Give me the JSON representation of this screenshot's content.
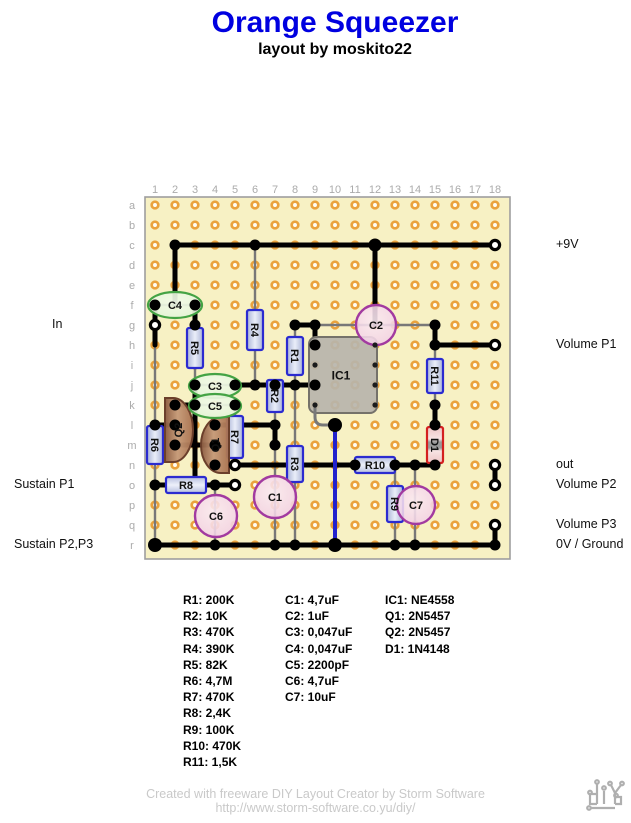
{
  "title": "Orange Squeezer",
  "subtitle": "layout by moskito22",
  "colors": {
    "title": "#0000E0",
    "board_bg": "#F7F1C4",
    "board_border": "#9E9E9E",
    "hole_ring": "#EAA23C",
    "hole_center": "#FFFDF4",
    "wire": "#000000",
    "blue_wire": "#2222CC",
    "lead": "#787878",
    "resistor_border": "#2B2BD0",
    "diode_border": "#D42020",
    "cap_border": "#A23AA0",
    "ecap_border": "#44A344",
    "transistor_border": "#6B3F2B",
    "ic_border": "#75726A",
    "grid_label": "#ABABAB",
    "footer": "#C9C9C9",
    "label_text": "#111111"
  },
  "board": {
    "origin_x": 155,
    "origin_y": 205,
    "pitch": 20,
    "cols": 18,
    "rows": 18,
    "frame": {
      "x": 145,
      "y": 197,
      "w": 365,
      "h": 362
    },
    "col_labels": [
      "1",
      "2",
      "3",
      "4",
      "5",
      "6",
      "7",
      "8",
      "9",
      "10",
      "11",
      "12",
      "13",
      "14",
      "15",
      "16",
      "17",
      "18"
    ],
    "row_labels": [
      "a",
      "b",
      "c",
      "d",
      "e",
      "f",
      "g",
      "h",
      "i",
      "j",
      "k",
      "l",
      "m",
      "n",
      "o",
      "p",
      "q",
      "r"
    ]
  },
  "left_labels": [
    {
      "text": "In",
      "x": 52,
      "row": 7
    },
    {
      "text": "Sustain P1",
      "x": 14,
      "row": 15
    },
    {
      "text": "Sustain P2,P3",
      "x": 14,
      "row": 18
    }
  ],
  "right_labels": [
    {
      "text": "+9V",
      "x": 556,
      "row": 3
    },
    {
      "text": "Volume P1",
      "x": 556,
      "row": 8
    },
    {
      "text": "out",
      "x": 556,
      "row": 14
    },
    {
      "text": "Volume P2",
      "x": 556,
      "row": 15
    },
    {
      "text": "Volume P3",
      "x": 556,
      "row": 17
    },
    {
      "text": "0V / Ground",
      "x": 556,
      "row": 18
    }
  ],
  "wires": [
    {
      "a": [
        2,
        3
      ],
      "b": [
        18,
        3
      ]
    },
    {
      "a": [
        2,
        3
      ],
      "b": [
        2,
        6
      ]
    },
    {
      "a": [
        12,
        3
      ],
      "b": [
        12,
        7
      ]
    },
    {
      "a": [
        8,
        7
      ],
      "b": [
        9,
        7
      ]
    },
    {
      "a": [
        9,
        7
      ],
      "b": [
        9,
        8
      ]
    },
    {
      "a": [
        15,
        7
      ],
      "b": [
        15,
        8
      ]
    },
    {
      "a": [
        15,
        8
      ],
      "b": [
        18,
        8
      ]
    },
    {
      "a": [
        5,
        10
      ],
      "b": [
        9,
        10
      ]
    },
    {
      "a": [
        1,
        6
      ],
      "b": [
        1,
        8
      ]
    },
    {
      "a": [
        3,
        6
      ],
      "b": [
        3,
        7
      ]
    },
    {
      "a": [
        3,
        10
      ],
      "b": [
        3,
        15
      ]
    },
    {
      "a": [
        2,
        11
      ],
      "b": [
        3,
        11
      ]
    },
    {
      "a": [
        1,
        12
      ],
      "b": [
        2,
        12
      ]
    },
    {
      "a": [
        2,
        13
      ],
      "b": [
        4,
        13
      ]
    },
    {
      "a": [
        4,
        12
      ],
      "b": [
        7,
        12
      ]
    },
    {
      "a": [
        7,
        12
      ],
      "b": [
        7,
        13
      ]
    },
    {
      "a": [
        5,
        14
      ],
      "b": [
        11,
        14
      ]
    },
    {
      "a": [
        13,
        14
      ],
      "b": [
        15,
        14
      ]
    },
    {
      "a": [
        15,
        11
      ],
      "b": [
        15,
        12
      ]
    },
    {
      "a": [
        1,
        15
      ],
      "b": [
        5,
        15
      ]
    },
    {
      "a": [
        1,
        18
      ],
      "b": [
        18,
        18
      ]
    },
    {
      "a": [
        18,
        14
      ],
      "b": [
        18,
        15
      ]
    },
    {
      "a": [
        18,
        17
      ],
      "b": [
        18,
        18
      ]
    },
    {
      "a": [
        10,
        12
      ],
      "b": [
        10,
        18
      ],
      "color": "blue"
    }
  ],
  "leads": [
    {
      "a": [
        6,
        3
      ],
      "b": [
        6,
        10
      ]
    },
    {
      "a": [
        3,
        7
      ],
      "b": [
        3,
        10
      ]
    },
    {
      "a": [
        8,
        7
      ],
      "b": [
        8,
        10
      ]
    },
    {
      "a": [
        7,
        10
      ],
      "b": [
        7,
        12
      ]
    },
    {
      "a": [
        8,
        10
      ],
      "b": [
        8,
        18
      ]
    },
    {
      "a": [
        1,
        8
      ],
      "b": [
        1,
        18
      ]
    },
    {
      "a": [
        5,
        11
      ],
      "b": [
        5,
        14
      ]
    },
    {
      "a": [
        13,
        14
      ],
      "b": [
        13,
        18
      ]
    },
    {
      "a": [
        15,
        8
      ],
      "b": [
        15,
        11
      ]
    },
    {
      "a": [
        15,
        12
      ],
      "b": [
        15,
        14
      ]
    },
    {
      "a": [
        7,
        13
      ],
      "b": [
        7,
        18
      ]
    },
    {
      "a": [
        9,
        7
      ],
      "b": [
        15,
        7
      ]
    },
    {
      "a": [
        4,
        15
      ],
      "b": [
        4,
        18
      ]
    },
    {
      "a": [
        14,
        14
      ],
      "b": [
        14,
        18
      ]
    },
    {
      "a": [
        1,
        6
      ],
      "b": [
        3,
        6
      ]
    },
    {
      "a": [
        3,
        10
      ],
      "b": [
        5,
        10
      ]
    },
    {
      "a": [
        3,
        11
      ],
      "b": [
        5,
        11
      ]
    }
  ],
  "ic_bent_lead": {
    "from": [
      9,
      11
    ],
    "to": [
      10,
      12
    ]
  },
  "dots": {
    "solid": [
      [
        2,
        3
      ],
      [
        6,
        3
      ],
      [
        12,
        3,
        6.5
      ],
      [
        1,
        6
      ],
      [
        3,
        6
      ],
      [
        3,
        7
      ],
      [
        8,
        7
      ],
      [
        9,
        7
      ],
      [
        15,
        7
      ],
      [
        9,
        8
      ],
      [
        15,
        8
      ],
      [
        3,
        10
      ],
      [
        5,
        10
      ],
      [
        6,
        10
      ],
      [
        7,
        10
      ],
      [
        8,
        10
      ],
      [
        9,
        10
      ],
      [
        2,
        11
      ],
      [
        3,
        11
      ],
      [
        5,
        11
      ],
      [
        15,
        11
      ],
      [
        1,
        12
      ],
      [
        2,
        12
      ],
      [
        4,
        12
      ],
      [
        7,
        12
      ],
      [
        15,
        12
      ],
      [
        10,
        12,
        7
      ],
      [
        2,
        13
      ],
      [
        4,
        13
      ],
      [
        7,
        13
      ],
      [
        4,
        14
      ],
      [
        11,
        14
      ],
      [
        13,
        14
      ],
      [
        14,
        14
      ],
      [
        15,
        14
      ],
      [
        1,
        15
      ],
      [
        4,
        15
      ],
      [
        1,
        18,
        7
      ],
      [
        4,
        18
      ],
      [
        7,
        18
      ],
      [
        8,
        18
      ],
      [
        10,
        18,
        7
      ],
      [
        13,
        18
      ],
      [
        14,
        18
      ],
      [
        18,
        18
      ]
    ],
    "hollow": [
      [
        1,
        7
      ],
      [
        18,
        3
      ],
      [
        18,
        8
      ],
      [
        18,
        14
      ],
      [
        18,
        15
      ],
      [
        18,
        17
      ],
      [
        5,
        14
      ],
      [
        5,
        15
      ]
    ],
    "pins": [
      [
        9,
        9
      ],
      [
        9,
        11
      ],
      [
        12,
        8
      ],
      [
        12,
        9
      ],
      [
        12,
        10
      ],
      [
        12,
        11
      ]
    ]
  },
  "components": [
    {
      "id": "R4",
      "type": "vres",
      "label": "R4",
      "cx": 255,
      "y1": 310,
      "y2": 350
    },
    {
      "id": "R5",
      "type": "vres",
      "label": "R5",
      "cx": 195,
      "y1": 328,
      "y2": 368
    },
    {
      "id": "R1",
      "type": "vres",
      "label": "R1",
      "cx": 295,
      "y1": 337,
      "y2": 375
    },
    {
      "id": "R2",
      "type": "vres",
      "label": "R2",
      "cx": 275,
      "y1": 380,
      "y2": 412
    },
    {
      "id": "R3",
      "type": "vres",
      "label": "R3",
      "cx": 295,
      "y1": 446,
      "y2": 482
    },
    {
      "id": "R6",
      "type": "vres",
      "label": "R6",
      "cx": 155,
      "y1": 426,
      "y2": 464
    },
    {
      "id": "R7",
      "type": "vres",
      "label": "R7",
      "cx": 235,
      "y1": 416,
      "y2": 458
    },
    {
      "id": "R11",
      "type": "vres",
      "label": "R11",
      "cx": 435,
      "y1": 359,
      "y2": 393
    },
    {
      "id": "R9",
      "type": "vres",
      "label": "R9",
      "cx": 395,
      "y1": 486,
      "y2": 522
    },
    {
      "id": "D1",
      "type": "vdiode",
      "label": "D1",
      "cx": 435,
      "y1": 427,
      "y2": 463
    },
    {
      "id": "R8",
      "type": "hres",
      "label": "R8",
      "cy": 485,
      "x1": 166,
      "x2": 206
    },
    {
      "id": "R10",
      "type": "hres",
      "label": "R10",
      "cy": 465,
      "x1": 355,
      "x2": 395
    },
    {
      "id": "IC1",
      "type": "ic",
      "label": "IC1",
      "x": 309,
      "y": 337,
      "w": 68,
      "h": 76
    },
    {
      "id": "Q2",
      "type": "transistor",
      "label": "Q2",
      "x": 165,
      "y1": 398,
      "y2": 462,
      "bulge": "right"
    },
    {
      "id": "Q1",
      "type": "transistor",
      "label": "Q1",
      "x": 229,
      "y1": 417,
      "y2": 473,
      "bulge": "left"
    },
    {
      "id": "C4",
      "type": "ecap",
      "label": "C4",
      "cx": 175,
      "cy": 305,
      "rx": 27,
      "ry": 13
    },
    {
      "id": "C3",
      "type": "ecap",
      "label": "C3",
      "cx": 215,
      "cy": 386,
      "rx": 26,
      "ry": 12
    },
    {
      "id": "C5",
      "type": "ecap",
      "label": "C5",
      "cx": 215,
      "cy": 406,
      "rx": 26,
      "ry": 12
    },
    {
      "id": "C1",
      "type": "cap",
      "label": "C1",
      "cx": 275,
      "cy": 497,
      "r": 21
    },
    {
      "id": "C2",
      "type": "cap",
      "label": "C2",
      "cx": 376,
      "cy": 325,
      "r": 20
    },
    {
      "id": "C6",
      "type": "cap",
      "label": "C6",
      "cx": 216,
      "cy": 516,
      "r": 21
    },
    {
      "id": "C7",
      "type": "cap",
      "label": "C7",
      "cx": 416,
      "cy": 505,
      "r": 19
    }
  ],
  "legend": {
    "columns": [
      {
        "x": 183,
        "items": [
          "R1: 200K",
          "R2: 10K",
          "R3: 470K",
          "R4: 390K",
          "R5: 82K",
          "R6: 4,7M",
          "R7: 470K",
          "R8: 2,4K",
          "R9: 100K",
          "R10: 470K",
          "R11: 1,5K"
        ]
      },
      {
        "x": 285,
        "items": [
          "C1: 4,7uF",
          "C2: 1uF",
          "C3: 0,047uF",
          "C4: 0,047uF",
          "C5: 2200pF",
          "C6: 4,7uF",
          "C7: 10uF"
        ]
      },
      {
        "x": 385,
        "items": [
          "IC1: NE4558",
          "Q1: 2N5457",
          "Q2: 2N5457",
          "D1: 1N4148"
        ]
      }
    ]
  },
  "footer": {
    "line1": "Created with freeware DIY Layout Creator by Storm Software",
    "line2": "http://www.storm-software.co.yu/diy/"
  },
  "logo_name": "diy-logo"
}
